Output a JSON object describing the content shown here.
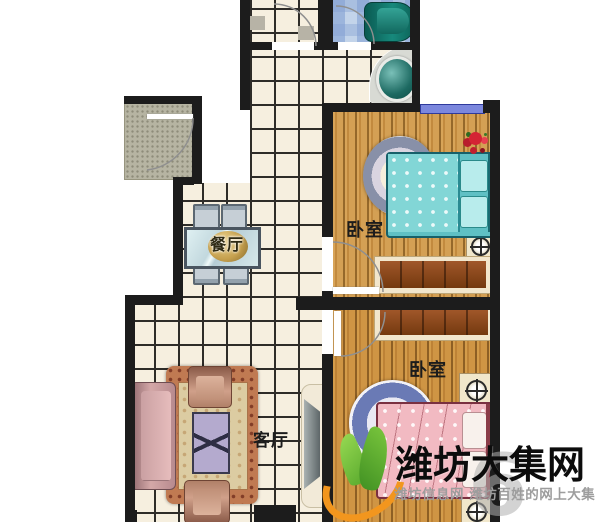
{
  "floor_plan": {
    "type": "apartment-floor-plan",
    "rooms": {
      "dining_label": "餐厅",
      "living_label": "客厅",
      "bedroom_top_label": "卧室",
      "bedroom_bottom_label": "卧室"
    },
    "fixtures": [
      "entry-door-mat",
      "kitchen-nook",
      "bathroom",
      "bathtub",
      "washbasin",
      "window",
      "dining-table",
      "dining-chairs",
      "sofa",
      "armchairs",
      "coffee-table",
      "living-rug",
      "tv-cabinet",
      "bed-teal",
      "bed-pink",
      "round-rug-gray",
      "round-rug-blue",
      "wardrobe",
      "nightstand",
      "compass-knob",
      "flower-pot"
    ],
    "colors": {
      "wall": "#1c1c1c",
      "tile_floor": "#f6efdf",
      "tile_line": "#2e2c28",
      "wood_floor": "#cf9a4e",
      "bath_tile": "#c3d4ea",
      "window_blue": "#7b87dd",
      "bed_teal": "#82d6d6",
      "bed_pink": "#f2bac2",
      "fixture_teal": "#15867a"
    }
  },
  "watermark": {
    "title": "潍坊大集网",
    "subtitle": "潍坊信息网 潍坊百姓的网上大集",
    "overlay_digit": "6",
    "logo_green": "#5fae2f",
    "logo_orange": "#f2961e"
  }
}
